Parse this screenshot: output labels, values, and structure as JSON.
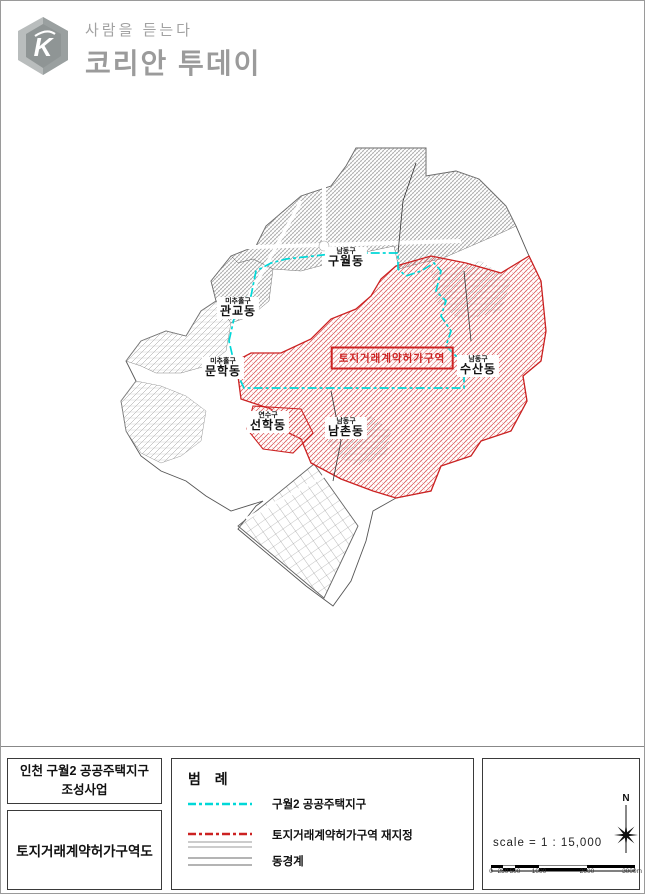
{
  "header": {
    "tagline": "사람을 듣는다",
    "title": "코리안 투데이",
    "logo_letter": "K"
  },
  "map": {
    "district_labels": [
      {
        "gu": "남동구",
        "dong": "구월동"
      },
      {
        "gu": "미추홀구",
        "dong": "관교동"
      },
      {
        "gu": "미추홀구",
        "dong": "문학동"
      },
      {
        "gu": "남동구",
        "dong": "수산동"
      },
      {
        "gu": "연수구",
        "dong": "선학동"
      },
      {
        "gu": "남동구",
        "dong": "남촌동"
      }
    ],
    "zone_label": "토지거래계약허가구역",
    "colors": {
      "district_zone_cyan": "#00d8d8",
      "restricted_red": "#cc2222",
      "urban_gray": "#8a8a8a"
    }
  },
  "footer": {
    "project_box": {
      "line1": "인천 구월2 공공주택지구",
      "line2": "조성사업"
    },
    "map_title_box": "토지거래계약허가구역도",
    "legend": {
      "title": "범 례",
      "items": [
        {
          "label": "구월2 공공주택지구",
          "style": "cyan-dashdot"
        },
        {
          "label": "토지거래계약허가구역 재지정",
          "style": "red-dashdot-underline"
        },
        {
          "label": "동경계",
          "style": "gray-double-line"
        }
      ]
    },
    "scale": {
      "text": "scale = 1 : 15,000",
      "north_label": "N",
      "bar_labels": [
        "0",
        "250",
        "500",
        "1000",
        "2000",
        "3000m"
      ]
    }
  }
}
